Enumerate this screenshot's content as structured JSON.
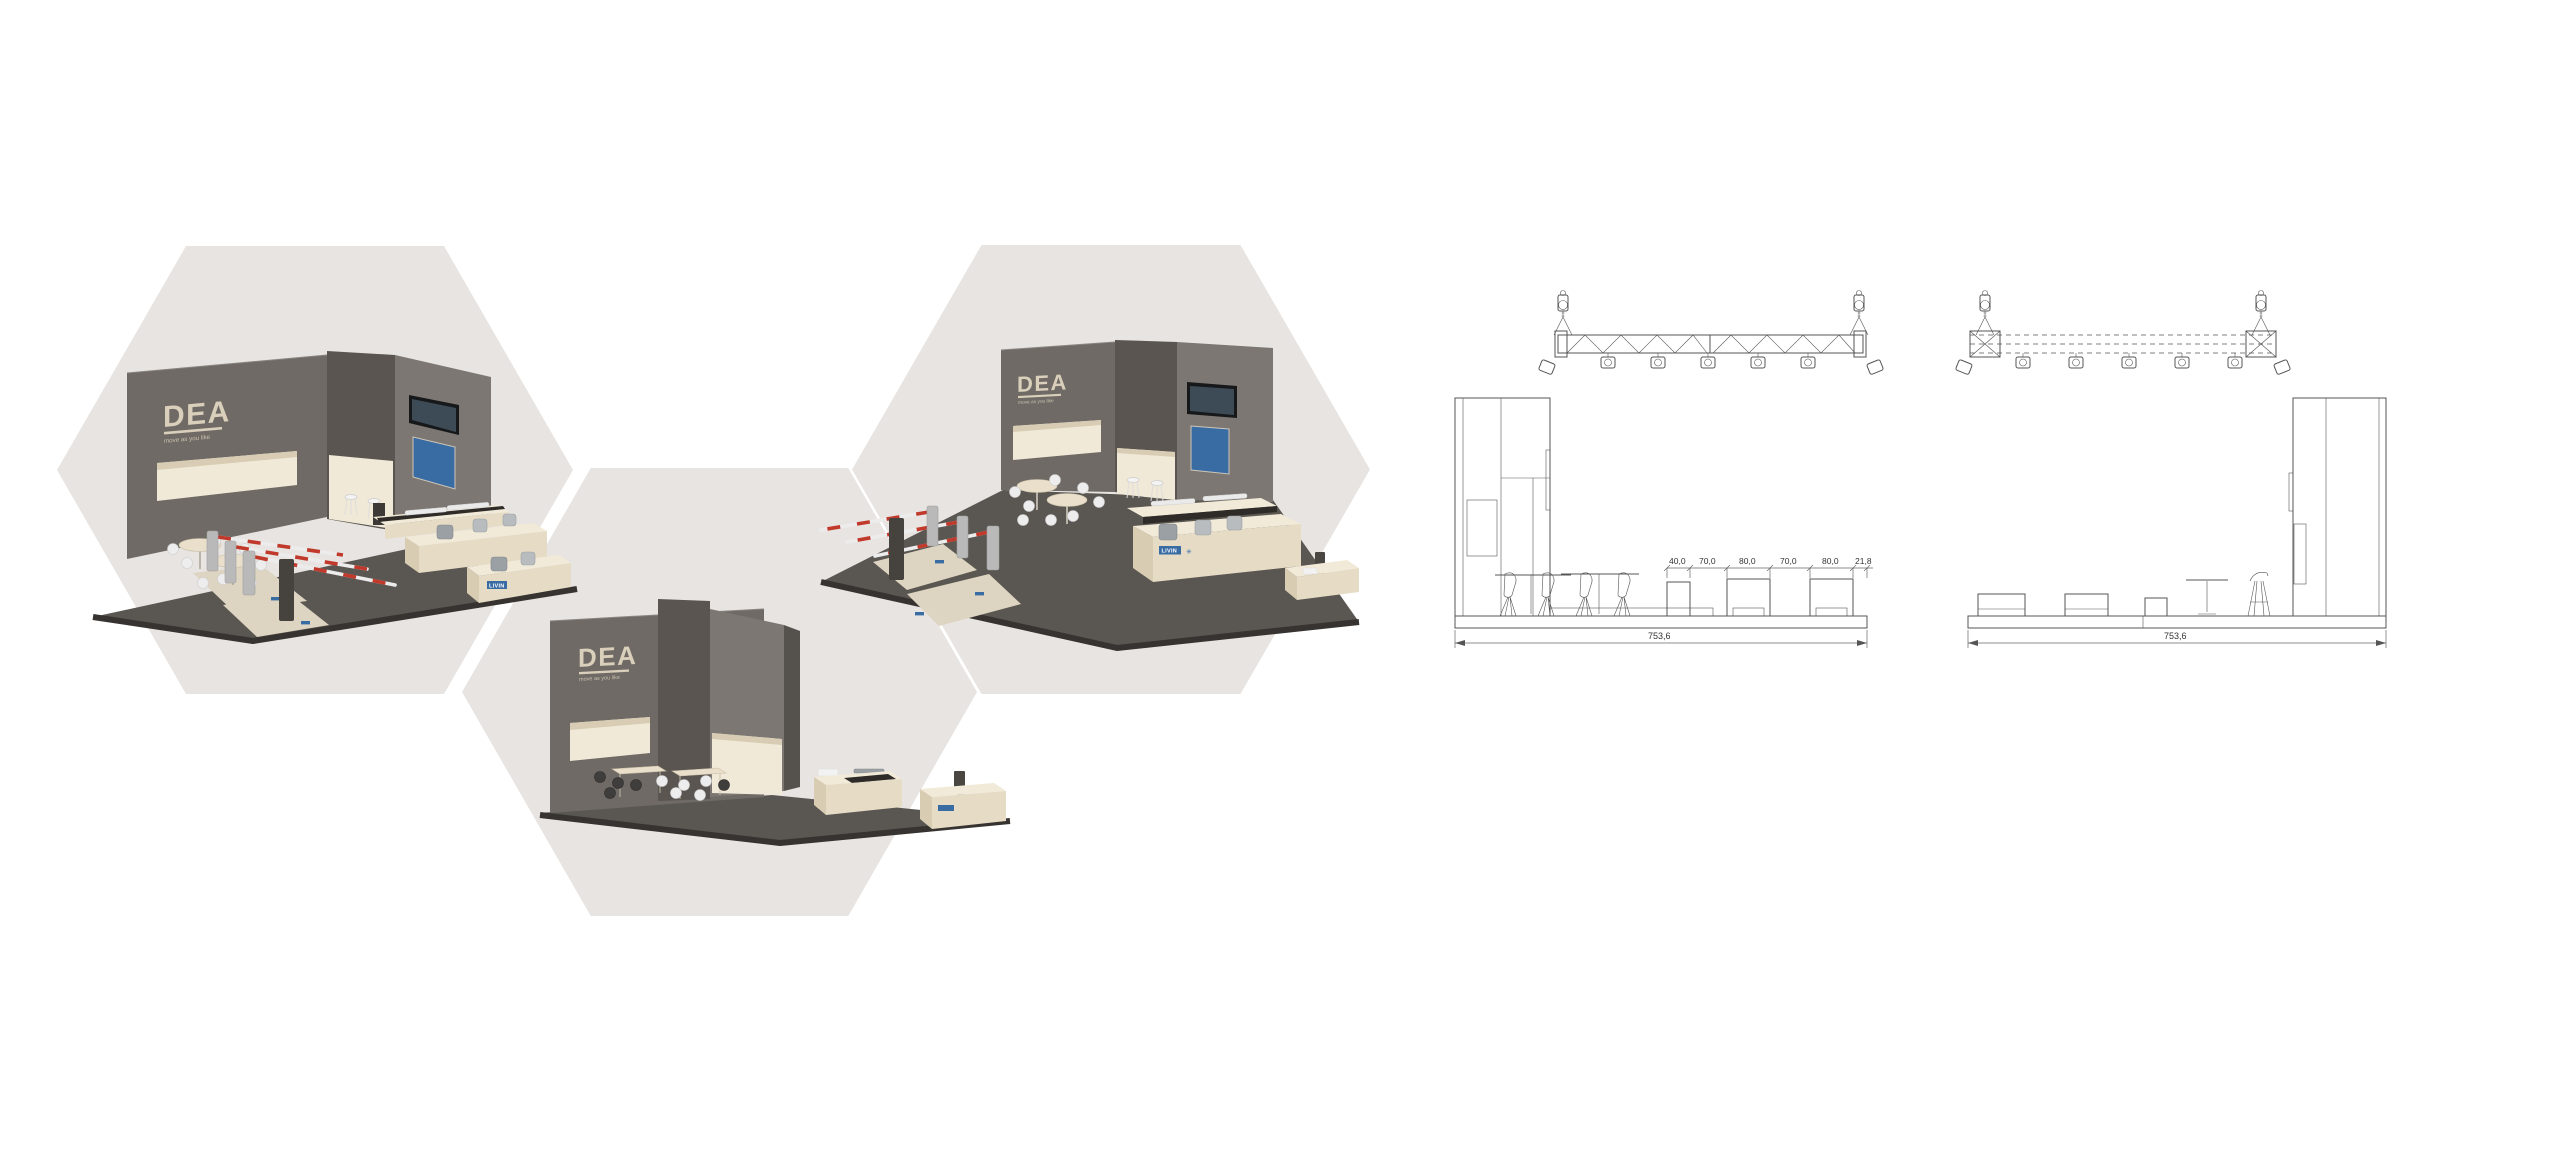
{
  "page": {
    "background": "#ffffff"
  },
  "brand": {
    "logo": "DEA",
    "tagline": "move as you like",
    "product_label": "LIVIN"
  },
  "drawings": {
    "front_elevation": {
      "segment_dims": [
        "40,0",
        "70,0",
        "80,0",
        "70,0",
        "80,0",
        "21,8"
      ],
      "total_dim": "753,6"
    },
    "side_elevation": {
      "total_dim": "753,6"
    }
  },
  "colors": {
    "hexagon": "#e8e4e1",
    "wall": "#6f6a65",
    "wall_dark": "#5a5550",
    "wall_light": "#7c7772",
    "floor": "#5a5651",
    "floor_edge": "#363330",
    "counter_top": "#f2ead8",
    "counter_front": "#e6dcc6",
    "counter_side": "#d8cdb3",
    "lightbox": "#f1e9d7",
    "carpet": "#ddd4c1",
    "poster_blue": "#3a6ca4",
    "screen_dark": "#17181a",
    "barrier_red": "#c0392b",
    "logo_beige": "#d9cfba",
    "line": "#555555"
  }
}
